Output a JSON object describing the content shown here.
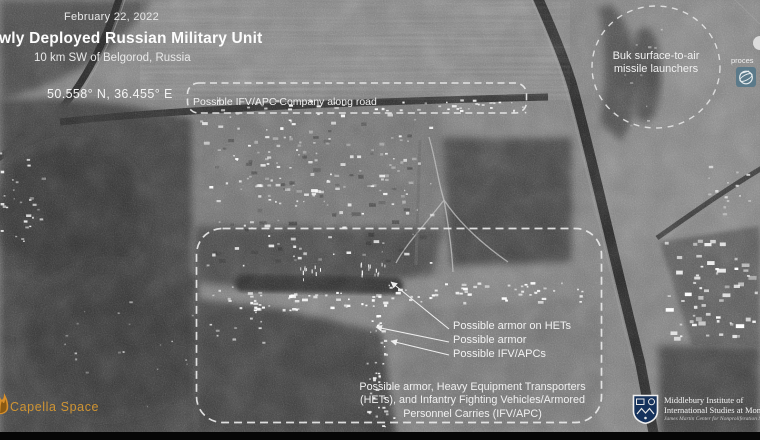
{
  "header": {
    "date": "February 22, 2022",
    "title": "wly Deployed Russian Military Unit",
    "subtitle": "10 km SW of Belgorod, Russia",
    "coordinates": "50.558° N, 36.455° E"
  },
  "annotations": {
    "road_company_label": "Possible IFV/APC Company along road",
    "buk_label_line1": "Buk surface-to-air",
    "buk_label_line2": "missile launchers",
    "pointer_labels": [
      "Possible armor on HETs",
      "Possible armor",
      "Possible IFV/APCs"
    ],
    "caption_line1": "Possible armor, Heavy Equipment Transporters",
    "caption_line2": "(HETs), and Infantry Fighting Vehicles/Armored",
    "caption_line3": "Personnel Carries (IFV/APC)"
  },
  "credits": {
    "capella_label": "Capella Space",
    "processed_by_partial": "proces",
    "institute_line1": "Middlebury Institute of",
    "institute_line2": "International Studies at Mon",
    "institute_line3": "James Martin Center for Nonproliferation Stu"
  },
  "colors": {
    "accent_orange": "#cf9433",
    "overlay_white": "#ededed",
    "processor_logo_blue": "#5b7a8a",
    "shield_navy": "#16325c"
  },
  "icons": {
    "capella_flame_icon": "flame",
    "processor_globe_icon": "globe-orbit",
    "middlebury_shield_icon": "crest-shield"
  }
}
